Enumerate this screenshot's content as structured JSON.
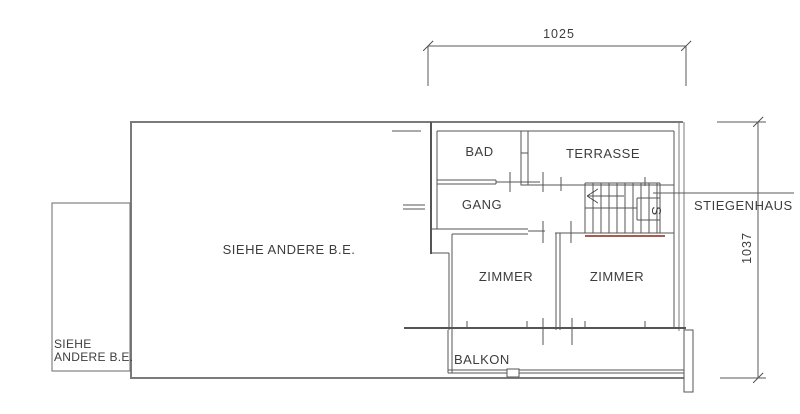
{
  "drawing": {
    "type": "architectural-floor-plan",
    "background": "#ffffff"
  },
  "labels": {
    "room_bad": "BAD",
    "room_terrasse": "TERRASSE",
    "room_gang": "GANG",
    "room_zimmer_left": "ZIMMER",
    "room_zimmer_right": "ZIMMER",
    "room_balkon": "BALKON",
    "main_area": "SIEHE ANDERE B.E.",
    "annex_area_line1": "SIEHE",
    "annex_area_line2": "ANDERE B.E.",
    "stairwell": "STIEGENHAUS",
    "stair_direction_marker": "S"
  },
  "dimensions": {
    "width_top": "1025",
    "height_right": "1037"
  },
  "colors": {
    "outer_wall": "#7a7a7a",
    "interior_wall": "#555555",
    "dimension_line": "#5a5a5a",
    "stair_marker_red": "#a85a50",
    "text": "#3d3d3d",
    "background": "#ffffff"
  }
}
